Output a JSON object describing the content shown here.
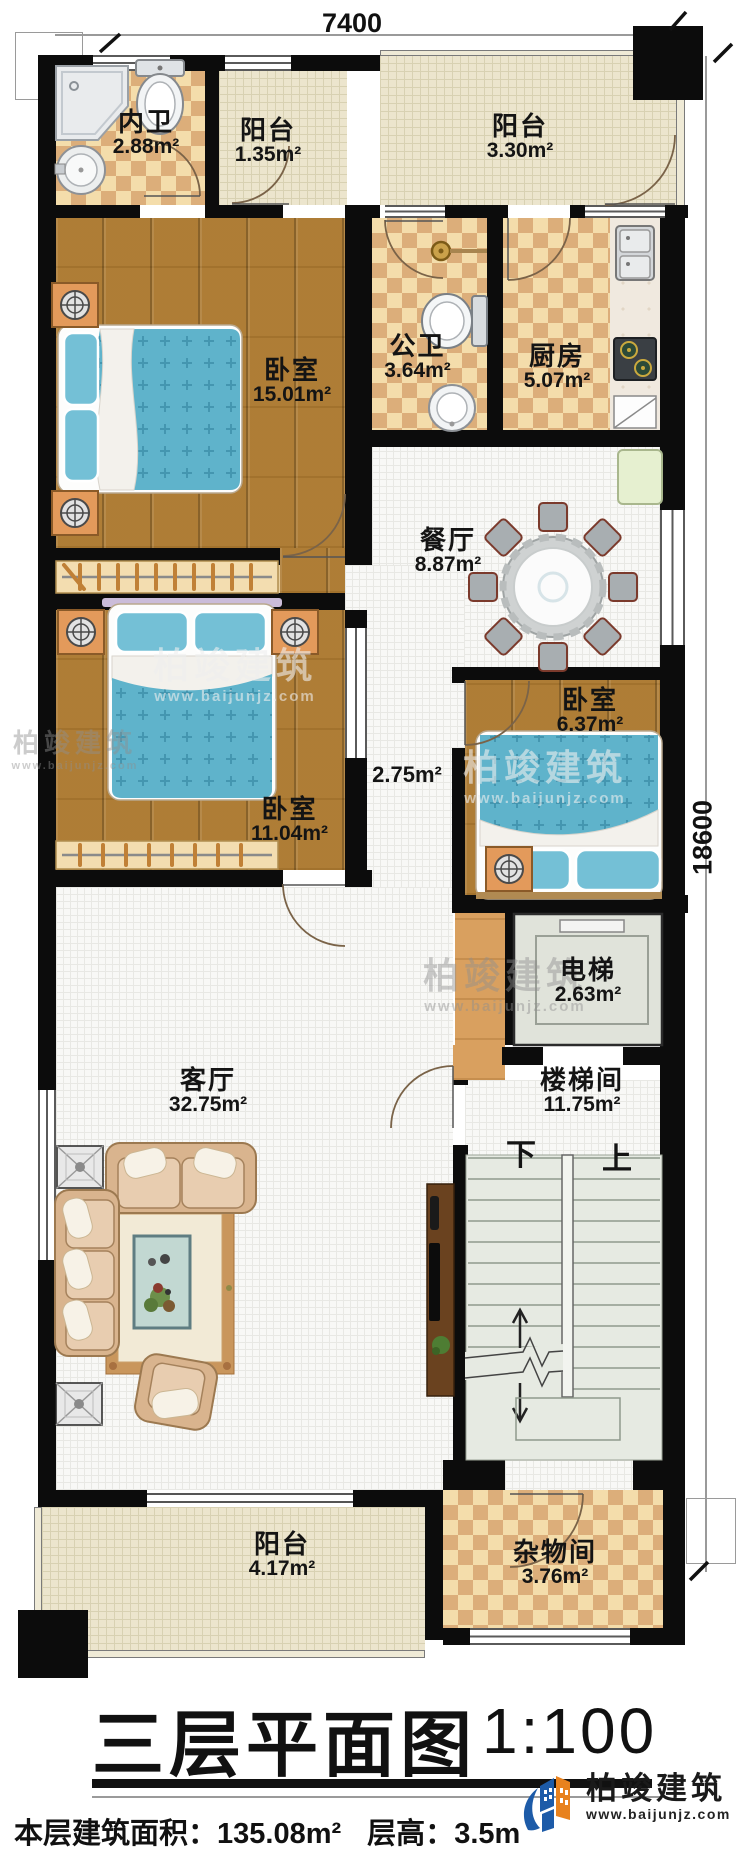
{
  "title_block": {
    "title": "三层平面图",
    "scale": "1:100"
  },
  "footer": {
    "area_label": "本层建筑面积：",
    "area_value": "135.08m²",
    "height_label": "层高：",
    "height_value": "3.5m"
  },
  "dimensions": {
    "width": "7400",
    "height": "18600"
  },
  "stairs": {
    "down": "下",
    "up": "上"
  },
  "rooms": {
    "ensuite_bath": {
      "name": "内卫",
      "area": "2.88m²"
    },
    "balcony_top_left": {
      "name": "阳台",
      "area": "1.35m²"
    },
    "balcony_top": {
      "name": "阳台",
      "area": "3.30m²"
    },
    "bedroom_master": {
      "name": "卧室",
      "area": "15.01m²"
    },
    "public_bath": {
      "name": "公卫",
      "area": "3.64m²"
    },
    "kitchen": {
      "name": "厨房",
      "area": "5.07m²"
    },
    "dining": {
      "name": "餐厅",
      "area": "8.87m²"
    },
    "bedroom_mid": {
      "name": "卧室",
      "area": "11.04m²"
    },
    "hallway": {
      "area": "2.75m²"
    },
    "bedroom_small": {
      "name": "卧室",
      "area": "6.37m²"
    },
    "elevator": {
      "name": "电梯",
      "area": "2.63m²"
    },
    "stairwell": {
      "name": "楼梯间",
      "area": "11.75m²"
    },
    "living": {
      "name": "客厅",
      "area": "32.75m²"
    },
    "balcony_bottom": {
      "name": "阳台",
      "area": "4.17m²"
    },
    "storage": {
      "name": "杂物间",
      "area": "3.76m²"
    }
  },
  "watermark": {
    "brand": "柏竣建筑",
    "url": "www.baijunjz.com"
  },
  "logo": {
    "brand": "柏竣建筑",
    "url": "www.baijunjz.com"
  }
}
